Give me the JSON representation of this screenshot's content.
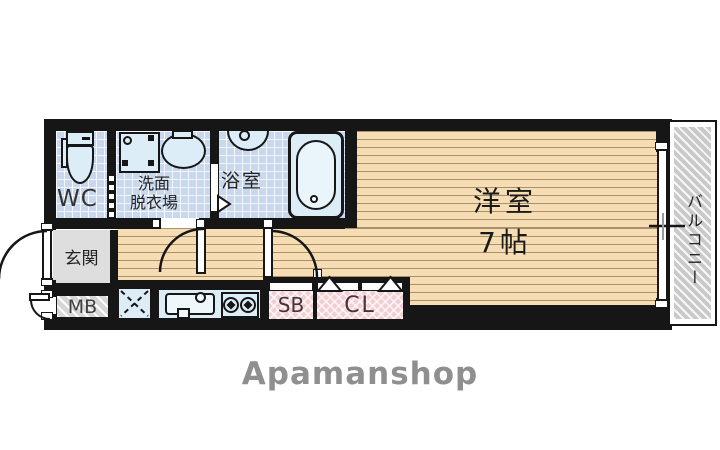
{
  "logo": {
    "text": "Apamanshop"
  },
  "rooms": {
    "wc": {
      "label": "WC"
    },
    "washroom": {
      "line1": "洗面",
      "line2": "脱衣場"
    },
    "bathroom": {
      "label": "浴室"
    },
    "western_room": {
      "label": "洋室",
      "size": "7帖"
    },
    "entrance": {
      "label": "玄関"
    },
    "meter_box": {
      "label": "MB"
    },
    "shoe_box": {
      "label": "SB"
    },
    "closet": {
      "label": "CL"
    },
    "balcony": {
      "label": "バルコニー"
    }
  },
  "colors": {
    "wall": "#161616",
    "tile": "#c8d8ee",
    "wood": "#f7ddb4",
    "fixture": "#dcedf8",
    "entrance_gray": "#dedede",
    "pink": "#f3cfd3",
    "logo": "#8f8f8f"
  }
}
